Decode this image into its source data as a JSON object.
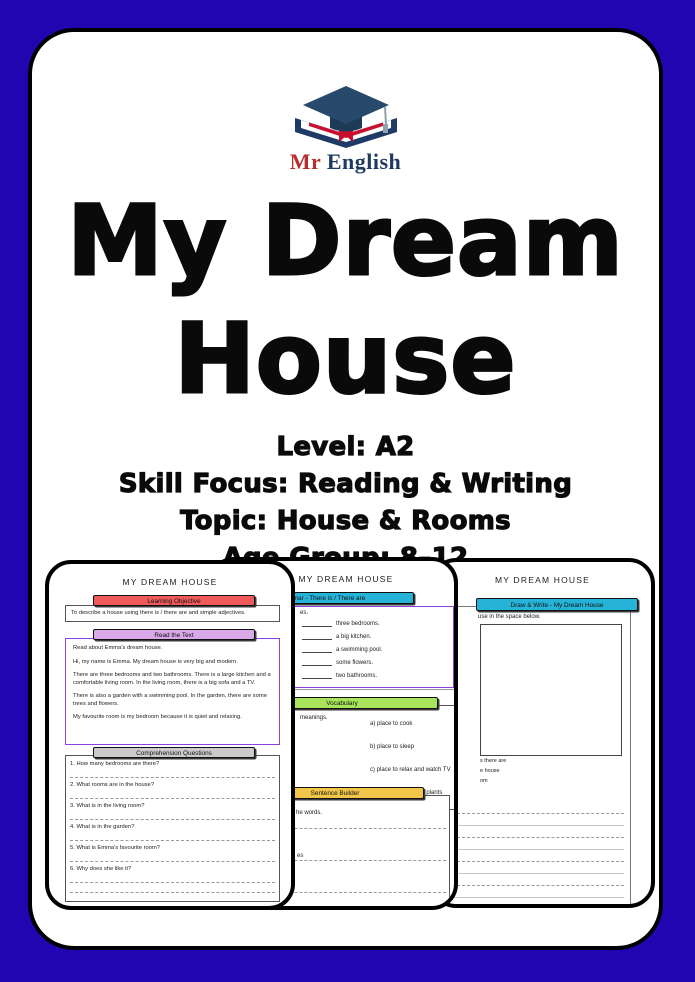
{
  "cover": {
    "brand": {
      "mr": "Mr",
      "english": "English"
    },
    "title_line1": "My Dream",
    "title_line2": "House",
    "details": {
      "level": "Level: A2",
      "skill_focus": "Skill Focus: Reading & Writing",
      "topic": "Topic: House & Rooms",
      "age_group": "Age Group: 8–12"
    }
  },
  "colors": {
    "background": "#2005B0",
    "banner_red": "#F05A5A",
    "banner_purple": "#D9A8E8",
    "reading_box_border": "#8C42E3",
    "banner_gray": "#CBCBCB",
    "banner_cyan": "#25B4D8",
    "banner_green": "#A8E55C",
    "banner_yellow": "#F2C64B",
    "logo_navy": "#27496b",
    "logo_red": "#c8102e"
  },
  "worksheets": {
    "page1": {
      "header": "MY DREAM HOUSE",
      "objective": {
        "banner": "Learning Objective",
        "text": "To describe a house using there is / there are and simple adjectives."
      },
      "reading": {
        "banner": "Read the Text",
        "paragraphs": [
          "Read about Emma's dream house.",
          "Hi, my name is Emma. My dream house is very big and modern.",
          "There are three bedrooms and two bathrooms. There is a large kitchen and a comfortable living room. In the living room, there is a big sofa and a TV.",
          "There is also a garden with a swimming pool. In the garden, there are some trees and flowers.",
          "My favourite room is my bedroom because it is quiet and relaxing."
        ]
      },
      "questions": {
        "banner": "Comprehension Questions",
        "items": [
          "1. How many bedrooms are there?",
          "2. What rooms are in the house?",
          "3. What is in the living room?",
          "4. What is in the garden?",
          "5. What is Emma's favourite room?",
          "6. Why does she like it?"
        ]
      }
    },
    "page2": {
      "header": "MY DREAM HOUSE",
      "grammar": {
        "banner": "Grammar - There is / There are",
        "intro_fragment": "es.",
        "blanks": [
          "three bedrooms.",
          "a big kitchen.",
          "a swimming pool.",
          "some flowers.",
          "two bathrooms."
        ]
      },
      "vocabulary": {
        "banner": "Vocabulary",
        "intro_fragment": "meanings.",
        "options": [
          "a) place to cook",
          "b) place to sleep",
          "c) place to relax and watch TV",
          "d) place outside with plants"
        ]
      },
      "sentence_builder": {
        "banner": "Sentence Builder",
        "intro_fragment": "he words.",
        "line_fragment": "es"
      }
    },
    "page3": {
      "header": "MY DREAM HOUSE",
      "draw_write": {
        "banner": "Draw & Write - My Dream House",
        "intro_fragment": "use in the space below.",
        "checklist_fragments": [
          "s there are",
          "e house",
          "om"
        ]
      }
    }
  }
}
